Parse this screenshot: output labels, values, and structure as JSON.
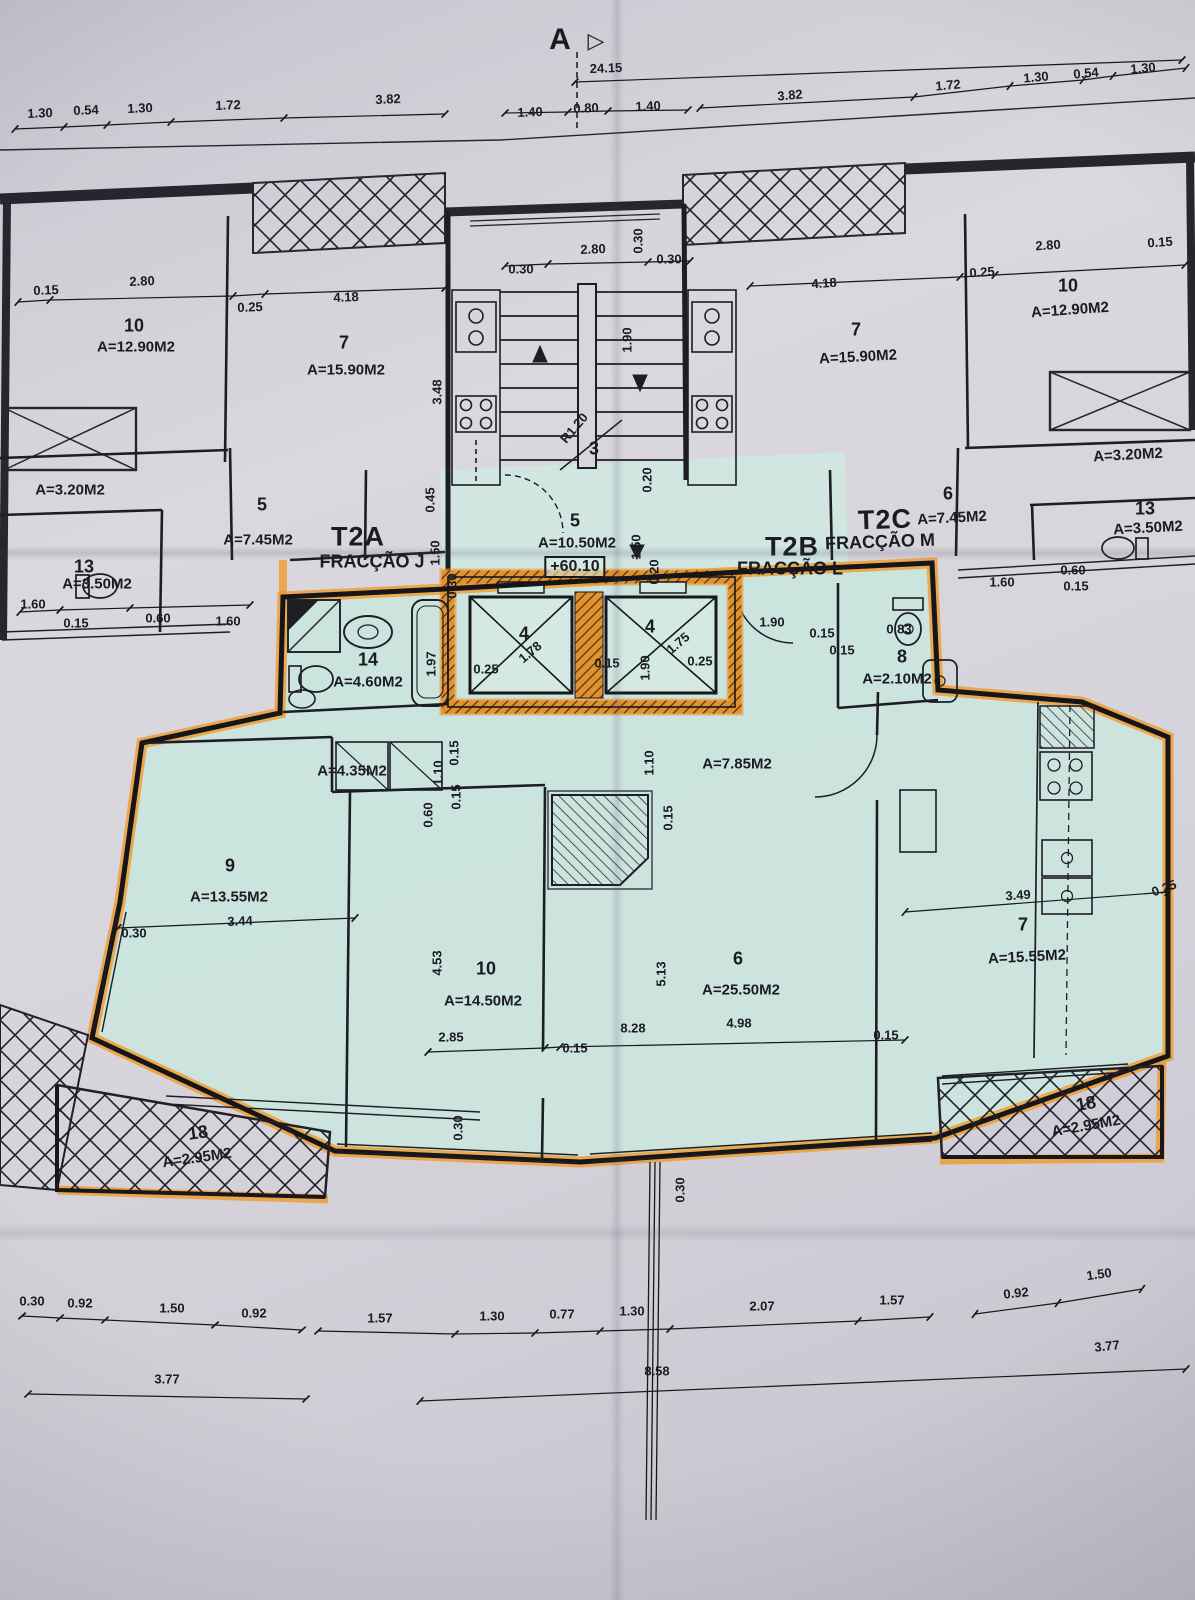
{
  "marker": {
    "label": "A",
    "arrow": "▷"
  },
  "elevation": "+60.10",
  "colors": {
    "highlight_orange": "#f09a2c",
    "unit_tint": "#cde7df",
    "paper": "#d7d4db",
    "ink": "#1b1b22"
  },
  "units": {
    "t2a": {
      "name": "T2A",
      "fraction": "FRACÇÃO J"
    },
    "t2b": {
      "name": "T2B",
      "fraction": "FRACÇÃO L"
    },
    "t2c": {
      "name": "T2C",
      "fraction": "FRACÇÃO M"
    }
  },
  "rooms": {
    "ul_10": {
      "num": "10",
      "area": "A=12.90M2"
    },
    "ul_7": {
      "num": "7",
      "area": "A=15.90M2"
    },
    "ul_balc": {
      "area": "A=3.20M2"
    },
    "ul_5": {
      "num": "5",
      "area": "A=7.45M2"
    },
    "ul_13": {
      "num": "13",
      "area": "A=3.50M2"
    },
    "stair": {
      "num": "3"
    },
    "hall5": {
      "num": "5",
      "area": "A=10.50M2"
    },
    "ur_7": {
      "num": "7",
      "area": "A=15.90M2"
    },
    "ur_10": {
      "num": "10",
      "area": "A=12.90M2"
    },
    "ur_balc": {
      "area": "A=3.20M2"
    },
    "ur_6": {
      "num": "6",
      "area": "A=7.45M2"
    },
    "ur_13": {
      "num": "13",
      "area": "A=3.50M2"
    },
    "bath14": {
      "num": "14",
      "area": "A=4.60M2"
    },
    "wc8": {
      "num": "8",
      "area": "A=2.10M2"
    },
    "hall_a": {
      "area": "A=4.35M2"
    },
    "hall_b": {
      "area": "A=7.85M2"
    },
    "bed9": {
      "num": "9",
      "area": "A=13.55M2"
    },
    "bed10": {
      "num": "10",
      "area": "A=14.50M2"
    },
    "living6": {
      "num": "6",
      "area": "A=25.50M2"
    },
    "kitchen7": {
      "num": "7",
      "area": "A=15.55M2"
    },
    "balc18l": {
      "num": "18",
      "area": "A=2.95M2"
    },
    "balc18r": {
      "num": "18",
      "area": "A=2.95M2"
    },
    "elev_l": {
      "num": "4"
    },
    "elev_r": {
      "num": "4"
    }
  },
  "dims": {
    "top_total": "24.15",
    "top": [
      "1.30",
      "0.54",
      "1.30",
      "1.72",
      "3.82",
      "1.40",
      "0.80",
      "1.40",
      "3.82",
      "1.72",
      "1.30",
      "0.54",
      "1.30"
    ],
    "ul": [
      "0.15",
      "2.80",
      "0.25",
      "4.18",
      "3.48"
    ],
    "ur": [
      "4.18",
      "0.25",
      "2.80",
      "0.15"
    ],
    "stair": [
      "2.80",
      "0.30",
      "0.30",
      "0.30",
      "1.90",
      "R1.20",
      "0.20"
    ],
    "ul_wc": [
      "1.60",
      "0.15",
      "0.60",
      "1.60"
    ],
    "t2a_v": [
      "0.45",
      "1.50",
      "0.30"
    ],
    "hall5_v": [
      "1.50",
      "0.20"
    ],
    "ur_side": [
      "1.60",
      "0.60",
      "0.15"
    ],
    "t2b": [
      "1.90",
      "0.15"
    ],
    "elev": [
      "1.97",
      "0.25",
      "1.78",
      "0.15",
      "1.90",
      "1.75",
      "0.25"
    ],
    "wc8": [
      "0.83",
      "0.15"
    ],
    "hall": [
      "0.15",
      "1.10",
      "0.15",
      "0.60",
      "1.10",
      "0.15"
    ],
    "bed9": [
      "3.44",
      "0.30"
    ],
    "bed10": [
      "4.53",
      "2.85",
      "0.15"
    ],
    "living6": [
      "5.13",
      "8.28",
      "4.98",
      "0.15"
    ],
    "kitchen7": [
      "3.49",
      "0.25"
    ],
    "bottom_v": [
      "0.30",
      "0.30"
    ],
    "b1": [
      "0.30",
      "0.92",
      "1.50",
      "0.92",
      "1.57",
      "1.30",
      "0.77",
      "1.30",
      "2.07",
      "1.57",
      "0.92",
      "1.50"
    ],
    "b2": [
      "3.77",
      "8.58",
      "3.77"
    ]
  }
}
